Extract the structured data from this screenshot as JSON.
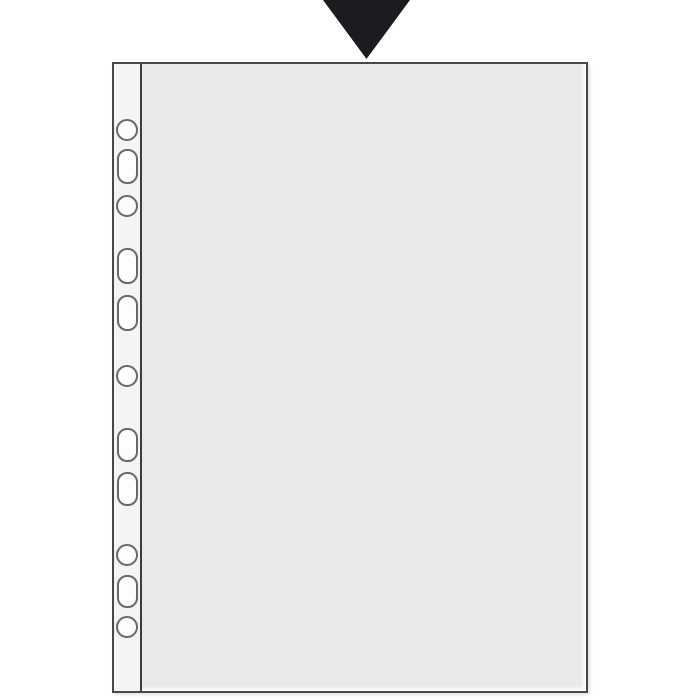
{
  "colors": {
    "page-bg": "#ffffff",
    "arrow": "#1b1b20",
    "sheet-body": "#e9e9ea",
    "strip": "#f4f4f5",
    "edge": "#48484a",
    "seam": "#3c3c3e",
    "hole-outline": "#69696b",
    "hole-fill": "#fdfdfd"
  },
  "arrow": {
    "direction": "down",
    "tip_x": 366,
    "tip_y": 59
  },
  "sheet_protector": {
    "kind": "transparent-punched-pocket",
    "left": 112,
    "top": 62,
    "width": 476,
    "height": 631,
    "strip_seam_x": 141,
    "holes": [
      {
        "type": "round",
        "cx": 127,
        "cy": 130,
        "w": 22,
        "h": 22
      },
      {
        "type": "oblong",
        "cx": 127,
        "cy": 166,
        "w": 21,
        "h": 35
      },
      {
        "type": "round",
        "cx": 127,
        "cy": 206,
        "w": 22,
        "h": 22
      },
      {
        "type": "oblong",
        "cx": 127,
        "cy": 266,
        "w": 21,
        "h": 36
      },
      {
        "type": "oblong",
        "cx": 127,
        "cy": 313,
        "w": 21,
        "h": 36
      },
      {
        "type": "round",
        "cx": 127,
        "cy": 376,
        "w": 22,
        "h": 22
      },
      {
        "type": "oblong",
        "cx": 127,
        "cy": 445,
        "w": 21,
        "h": 34
      },
      {
        "type": "oblong",
        "cx": 127,
        "cy": 489,
        "w": 21,
        "h": 34
      },
      {
        "type": "round",
        "cx": 127,
        "cy": 555,
        "w": 22,
        "h": 22
      },
      {
        "type": "oblong",
        "cx": 127,
        "cy": 591,
        "w": 21,
        "h": 33
      },
      {
        "type": "round",
        "cx": 127,
        "cy": 627,
        "w": 22,
        "h": 22
      }
    ]
  }
}
